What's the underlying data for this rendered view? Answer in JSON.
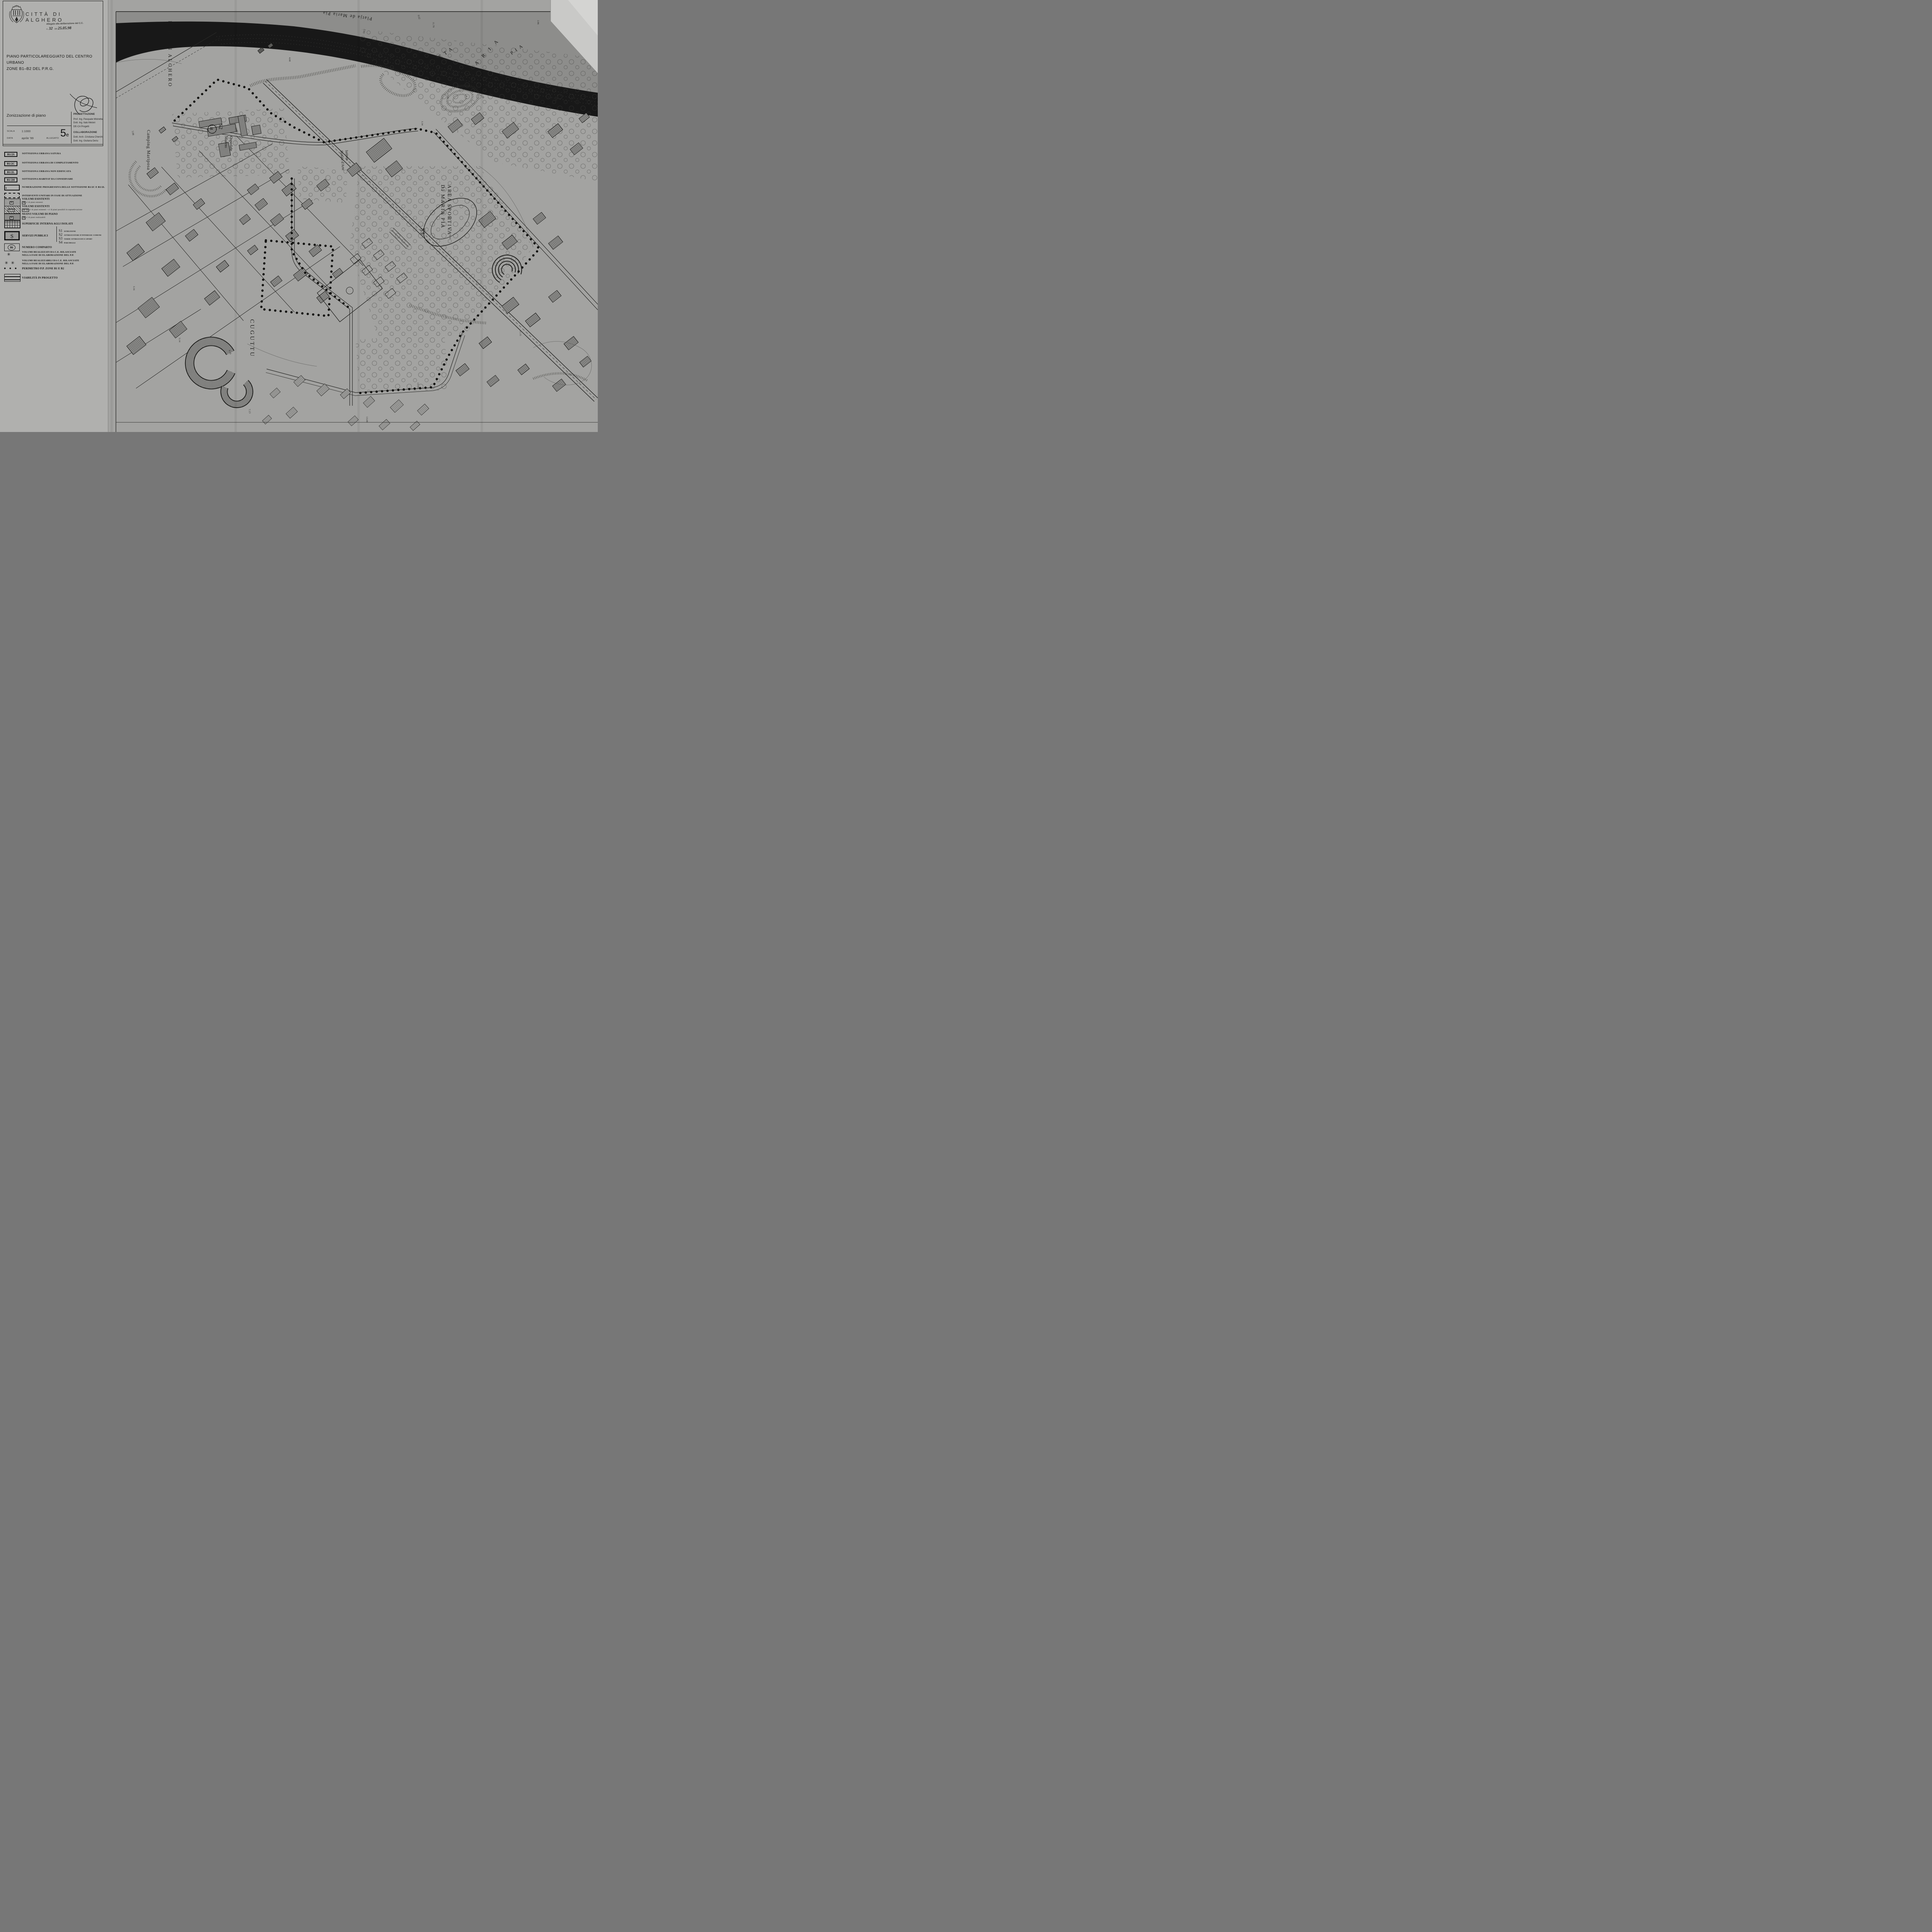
{
  "header": {
    "municipality": "CITTÀ DI ALGHERO",
    "stamp_line1": "Allegato alla deliberazione del C.C.",
    "stamp_n_label": "n.",
    "stamp_n_value": "32",
    "stamp_del_label": "del",
    "stamp_date": "25.05.98"
  },
  "title_block": {
    "title_line1": "PIANO PARTICOLAREGGIATO DEL CENTRO URBANO",
    "title_line2": "ZONE B1–B2 DEL P.R.G.",
    "subtitle": "Zonizzazione di piano",
    "scala_label": "SCALA",
    "scala_value": "1:1000",
    "data_label": "DATA",
    "data_value": "aprile '99",
    "allegato_label": "ALLEGATO",
    "allegato_number": "5",
    "allegato_letter": "e",
    "progettazione_label": "PROGETTAZIONE",
    "progettazione": [
      "Prof. Ing. Pasquale Mistretta",
      "Dott. Ing. Italo Meloni",
      "DE-CA Progetti"
    ],
    "collaborazione_label": "COLLABORAZIONE",
    "collaborazione": [
      "Dott. Arch. Cristiana Cherchi",
      "Dott. Ing. Giuliana Deriu"
    ]
  },
  "legend": {
    "zones": [
      {
        "code": "B1/2S",
        "label": "SOTTOZONA URBANA SATURA"
      },
      {
        "code": "B1/2C",
        "label": "SOTTOZONA URBANA DI COMPLETAMENTO"
      },
      {
        "code": "B1/2L",
        "label": "SOTTOZONA URBANA NON EDIFICATA"
      },
      {
        "code": "B1/2H",
        "label": "SOTTOZONA HABITAT DA CONSERVARE"
      }
    ],
    "numerazione": {
      "symbol": "1",
      "label": "NUMERAZIONE PROGRESSIVA DELLE SOTTOZONE B1/2C E B1/2L"
    },
    "interventi": {
      "label": "INTERVENTI UNITARI IN FASE DI ATTUAZIONE"
    },
    "volumi_esistenti": {
      "label": "VOLUMI ESISTENTI",
      "tag": "2p",
      "sub": "n' di piani esistenti"
    },
    "volumi_sopraelevazione": {
      "label": "VOLUMI ESISTENTI",
      "tag": "2p+1p",
      "sub": "n' di piani esistenti + n' di piani possibili in sopraelevazione"
    },
    "nuovi_volumi": {
      "label": "NUOVI VOLUMI DI PIANO",
      "tag": "2p",
      "sub": "n' di piani realizzabili"
    },
    "superficie": {
      "label": "SUPERFICIE INTERNA AGLI ISOLATI"
    },
    "servizi": {
      "symbol": "S",
      "label": "SERVIZI PUBBLICI",
      "items": [
        {
          "code": "S1",
          "label": "ISTRUZIONE"
        },
        {
          "code": "S2",
          "label": "ATTREZZATURE D'INTERESSE COMUNE"
        },
        {
          "code": "S3",
          "label": "VERDE ATTREZZATO E SPORT"
        },
        {
          "code": "S4",
          "label": "PARCHEGGI"
        }
      ]
    },
    "comparto": {
      "symbol": "86",
      "label": "NUMERO COMPARTO"
    },
    "volumi_realizzati": {
      "symbol": "✳",
      "line1": "VOLUMI REALIZZATI DA C.E. RILASCIATE",
      "line2": "NELLA FASE DI ELABORAZIONE DEL P.P."
    },
    "volumi_realizzabili": {
      "symbol": "✳ ✳",
      "line1": "VOLUMI REALIZZABILI DA C.E. RILASCIATE",
      "line2": "NELLA FASE DI ELABORAZIONE DEL P.P."
    },
    "perimetro": {
      "symbol": "● ● ●",
      "label": "PERIMETRO P.P. ZONE B1 E B2"
    },
    "viabilita": {
      "label": "VIABILITÀ IN PROGETTO"
    }
  },
  "map": {
    "sea_label": "RADA DI ALGHERO",
    "beach_label": "Platja de Maria Pia",
    "pineta_word1": "PINETA",
    "pineta_word2": "MARIA",
    "pineta_word3": "PIA",
    "sport_line1": "AREA SPORTIVA",
    "sport_line2": "DI MARIA PIA",
    "sport_code": "S3",
    "hospital_code": "S2",
    "hospital_line1": "Ospedale",
    "hospital_line2": "Marino",
    "helipad": "H",
    "camping_label": "Camping Mariposa",
    "district_label": "CUGUTTU",
    "school_line1": "Istituto",
    "school_line2": "Statale d'Arte",
    "elevations": [
      "11.79",
      "2.50",
      "0.62",
      "3.72",
      "2.86",
      "4.05",
      "2.88",
      "5.98",
      "8.10",
      "3.34",
      "13.98",
      "2.03",
      "4.08",
      "13.15",
      "13.08",
      "11.15",
      "6.16",
      "7.13",
      "5.14",
      "3.16"
    ]
  }
}
